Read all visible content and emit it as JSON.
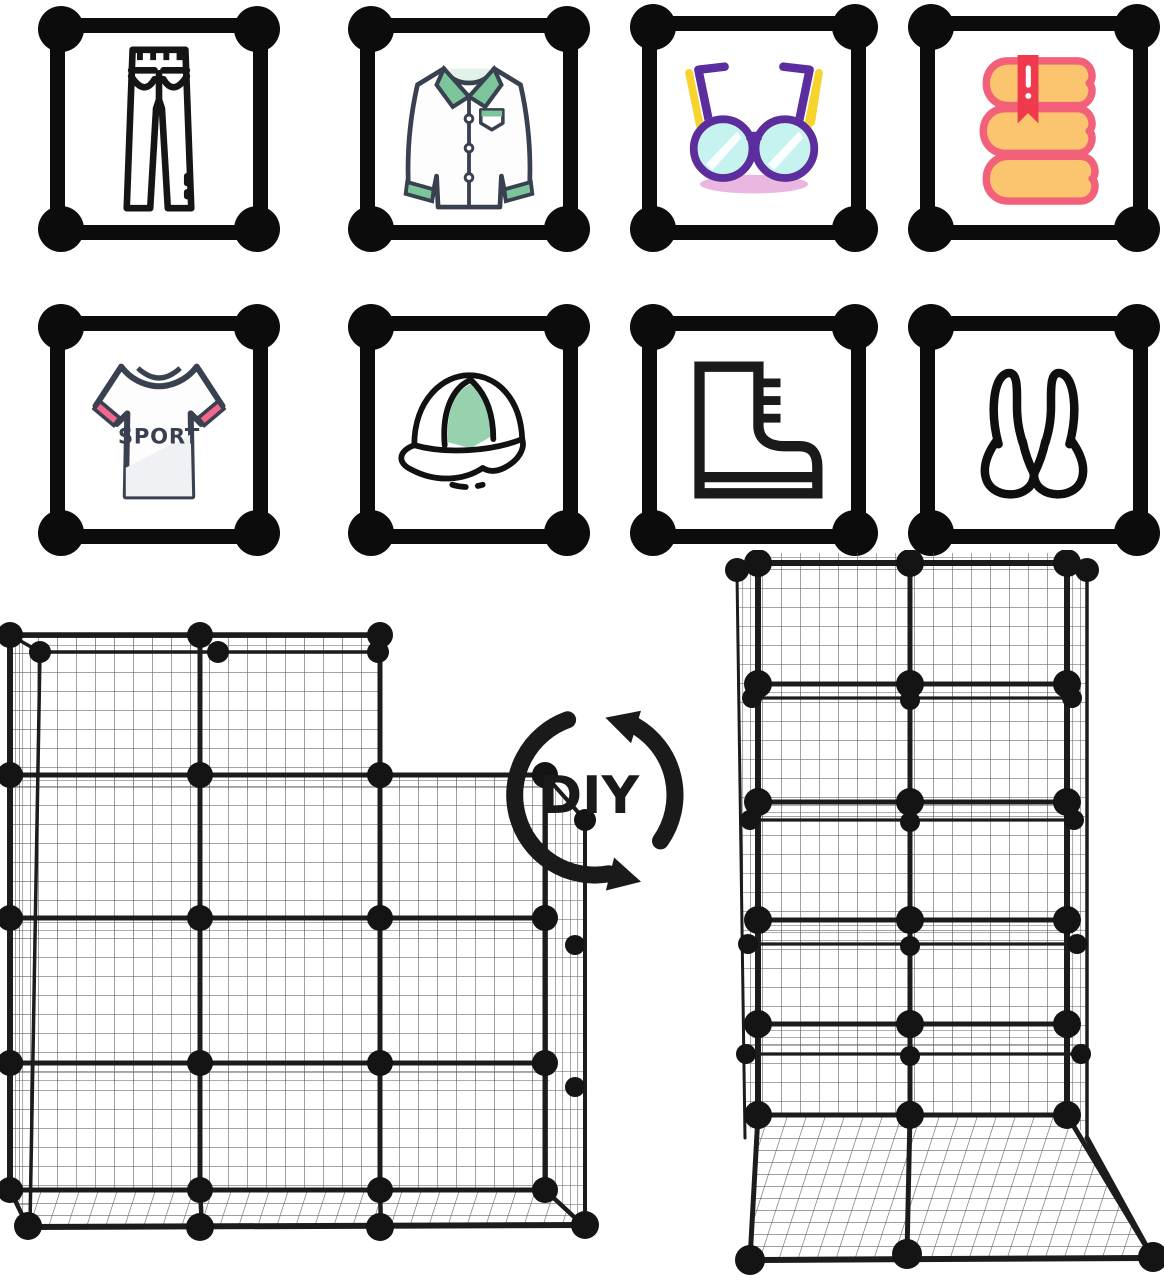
{
  "canvas": {
    "width": 1164,
    "height": 1280,
    "background": "#ffffff"
  },
  "icon_grid": {
    "rows": 2,
    "cols": 4,
    "frame_color": "#0c0c0c",
    "items": [
      {
        "id": "jeans",
        "label": ""
      },
      {
        "id": "shirt",
        "label": ""
      },
      {
        "id": "glasses",
        "label": ""
      },
      {
        "id": "books",
        "label": ""
      },
      {
        "id": "sport-tshirt",
        "label": "SPORT"
      },
      {
        "id": "cap",
        "label": ""
      },
      {
        "id": "boot",
        "label": ""
      },
      {
        "id": "bra",
        "label": ""
      }
    ]
  },
  "diy_badge": {
    "label": "DIY",
    "color": "#1a1a1a"
  },
  "racks": {
    "left": {
      "name": "wire-cube-organizer-staircase",
      "connector": "ball"
    },
    "right": {
      "name": "wire-cube-organizer-tower",
      "connector": "ball"
    }
  },
  "colors": {
    "frame_black": "#0c0c0c",
    "outline_navy": "#39404f",
    "shirt_green": "#7cc49a",
    "shirt_green_pale": "#e2f2e8",
    "glasses_purple": "#5b2d9e",
    "glasses_yellow": "#f6d32d",
    "glasses_lens": "#c6f3ef",
    "glasses_shadow": "#e9b7e0",
    "book_fill": "#fbc46e",
    "book_outline": "#f2607a",
    "bookmark_red": "#ee3a4c",
    "tshirt_pink": "#f2688c",
    "cap_green": "#98d1ae",
    "wire_dark": "#1c1c1c",
    "wire_mesh": "#6e6e6e"
  }
}
